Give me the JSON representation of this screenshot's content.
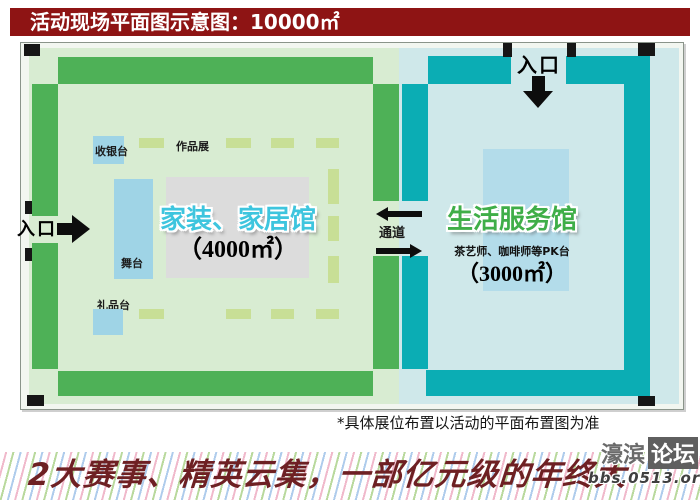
{
  "banner": {
    "title": "活动现场平面图示意图：10000㎡"
  },
  "plan": {
    "left_hall": {
      "name": "家装、家居馆",
      "area": "（4000㎡）",
      "cashier_label": "收银台",
      "works_expo_label": "作品展",
      "stage_label": "舞台",
      "gift_counter_label": "礼品台",
      "entrance_label": "入口"
    },
    "right_hall": {
      "name": "生活服务馆",
      "area": "（3000㎡）",
      "pk_stage_label": "茶艺师、咖啡师等PK台",
      "entrance_label": "入口"
    },
    "corridor_label": "通道"
  },
  "note": "*具体展位布置以活动的平面布置图为准",
  "footer": {
    "slogan": "2大赛事、精英云集，一部亿元级的年终大"
  },
  "watermark": {
    "name_left": "濠滨",
    "name_right": "论坛",
    "url": "bbs.0513.org"
  },
  "colors": {
    "banner_bg": "#8e1414",
    "green_band": "#4eb157",
    "pale_green": "#d8ecd2",
    "teal_band": "#0badb4",
    "pale_cyan": "#cfe8ea",
    "light_blue_box": "#9fd4e6",
    "inner_blue": "#b3dcea",
    "gray_zone": "#dcdcdc",
    "booth_dash": "#c8df96",
    "left_title_text": "#3ec5de",
    "right_title_text": "#3fae48",
    "slogan_text": "#6e2023"
  }
}
